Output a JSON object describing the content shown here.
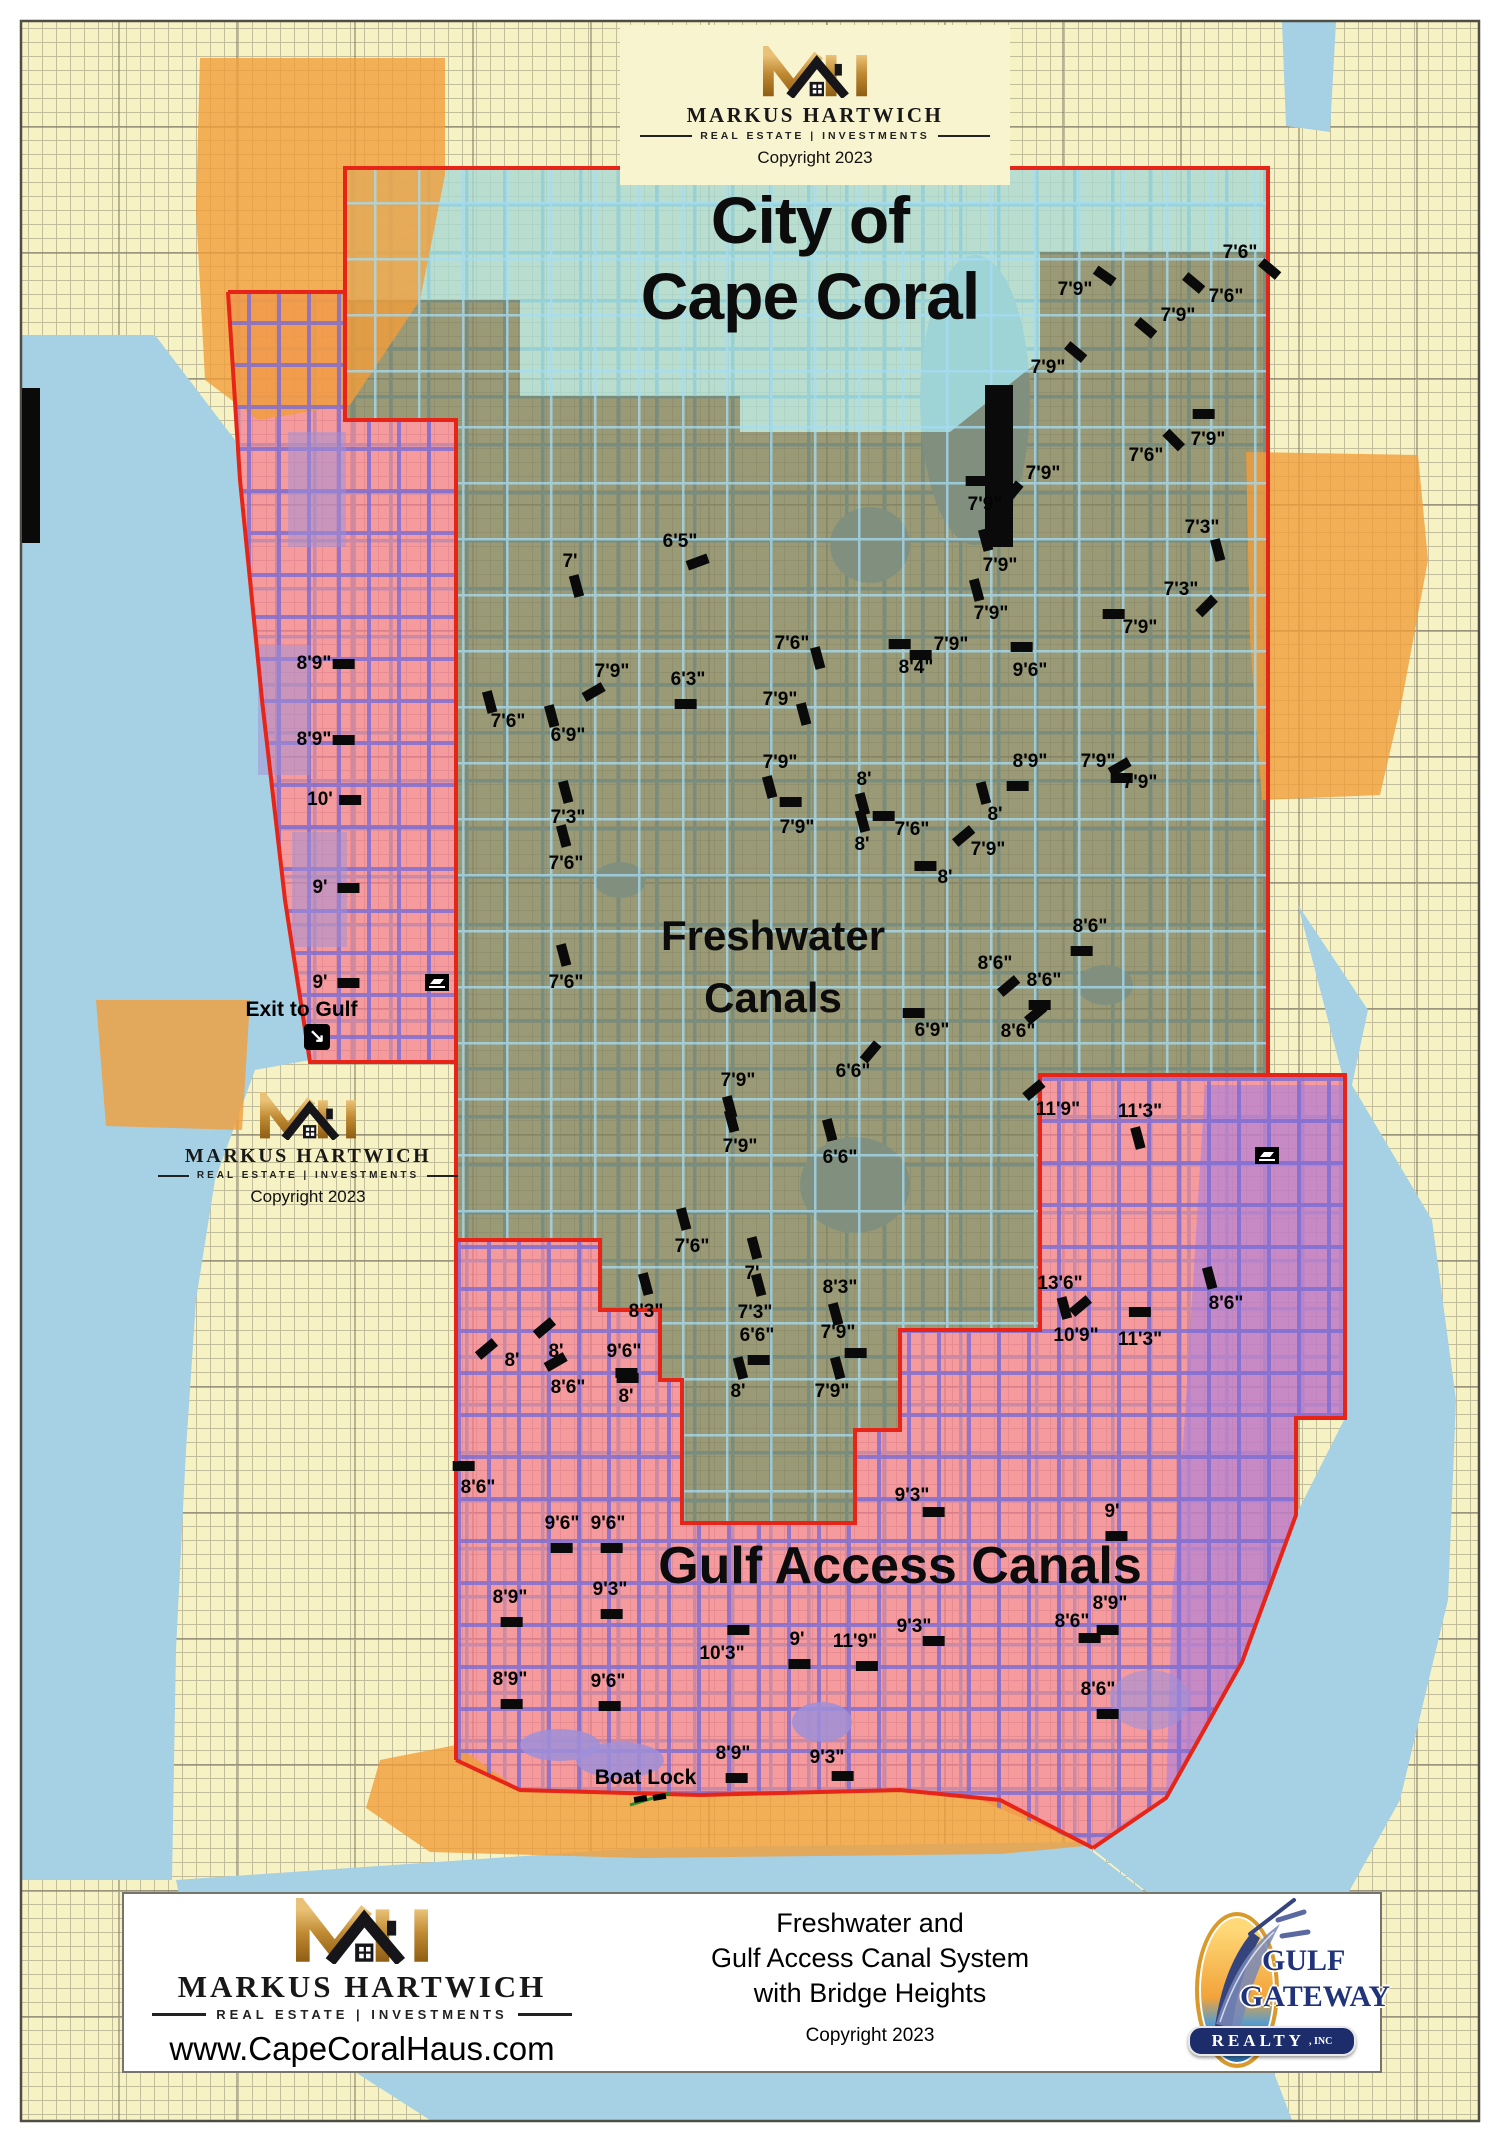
{
  "branding": {
    "monogram": "MH",
    "name": "MARKUS HARTWICH",
    "tagline": "REAL ESTATE | INVESTMENTS",
    "copyright": "Copyright 2023",
    "website": "www.CapeCoralHaus.com"
  },
  "map": {
    "title_line1": "City of",
    "title_line2": "Cape Coral",
    "freshwater_label_line1": "Freshwater",
    "freshwater_label_line2": "Canals",
    "gulf_access_label": "Gulf Access Canals",
    "exit_to_gulf_label": "Exit to Gulf",
    "boat_lock_label": "Boat Lock",
    "colors": {
      "land": "#f7f2c4",
      "water": "#a6d0e4",
      "canal_blue": "#58b6e4",
      "canal_purple": "#7b6cd4",
      "teal": "#a8d8d4",
      "olive": "#818162",
      "pink": "#f4798f",
      "violet": "#a97fe0",
      "orange": "#f19e39",
      "boundary_red": "#e62417",
      "marker_black": "#0a0a0a",
      "gold": "#c98a2e",
      "navy": "#1d2d6b"
    },
    "bridge_heights": [
      [
        "7'6\"",
        1240,
        253,
        30,
        16,
        40
      ],
      [
        "7'9\"",
        1075,
        290,
        30,
        -14,
        35
      ],
      [
        "7'6\"",
        1226,
        297,
        -32,
        -14,
        40
      ],
      [
        "7'9\"",
        1178,
        316,
        -32,
        12,
        40
      ],
      [
        "7'9\"",
        1048,
        368,
        28,
        -16,
        40
      ],
      [
        "7'9\"",
        1208,
        440,
        -4,
        -26,
        0
      ],
      [
        "7'6\"",
        1146,
        456,
        28,
        -16,
        45
      ],
      [
        "7'9\"",
        1043,
        474,
        -30,
        18,
        -50
      ],
      [
        "7'9\"",
        985,
        505,
        -8,
        -24,
        0
      ],
      [
        "7'3\"",
        1202,
        528,
        16,
        22,
        75
      ],
      [
        "7'9\"",
        1000,
        566,
        -14,
        -26,
        75
      ],
      [
        "7'3\"",
        1181,
        590,
        26,
        16,
        -45
      ],
      [
        "7'9\"",
        991,
        614,
        -14,
        -24,
        75
      ],
      [
        "7'9\"",
        1140,
        628,
        -26,
        -14,
        0
      ],
      [
        "7'9\"",
        951,
        645,
        -30,
        10,
        0
      ],
      [
        "8'4\"",
        916,
        668,
        -16,
        -24,
        0
      ],
      [
        "9'6\"",
        1030,
        671,
        -8,
        -24,
        0
      ],
      [
        "8'9\"",
        1030,
        762,
        -12,
        24,
        0
      ],
      [
        "7'9\"",
        1098,
        762,
        24,
        16,
        0
      ],
      [
        "7'9\"",
        1140,
        783,
        -20,
        -16,
        -30
      ],
      [
        "8'",
        995,
        815,
        -12,
        -22,
        75
      ],
      [
        "7'6\"",
        912,
        830,
        -28,
        -14,
        0
      ],
      [
        "7'9\"",
        988,
        850,
        -24,
        -14,
        -40
      ],
      [
        "8'",
        945,
        878,
        -20,
        -12,
        0
      ],
      [
        "6'5\"",
        680,
        542,
        18,
        20,
        -20
      ],
      [
        "7'",
        570,
        562,
        6,
        24,
        75
      ],
      [
        "7'6\"",
        792,
        644,
        26,
        14,
        75
      ],
      [
        "7'9\"",
        612,
        672,
        -18,
        20,
        -30
      ],
      [
        "6'3\"",
        688,
        680,
        -2,
        24,
        0
      ],
      [
        "7'9\"",
        780,
        700,
        24,
        14,
        75
      ],
      [
        "7'6\"",
        508,
        722,
        -18,
        -20,
        75
      ],
      [
        "6'9\"",
        568,
        736,
        -16,
        -20,
        75
      ],
      [
        "7'9\"",
        780,
        763,
        -10,
        24,
        75
      ],
      [
        "8'",
        864,
        780,
        -2,
        24,
        75
      ],
      [
        "7'3\"",
        568,
        818,
        -2,
        -26,
        75
      ],
      [
        "7'9\"",
        797,
        828,
        -6,
        -26,
        0
      ],
      [
        "8'",
        862,
        845,
        0,
        -24,
        75
      ],
      [
        "7'6\"",
        566,
        864,
        -2,
        -28,
        75
      ],
      [
        "7'6\"",
        566,
        983,
        -2,
        -28,
        75
      ],
      [
        "8'9\"",
        314,
        664,
        30,
        0,
        0
      ],
      [
        "8'9\"",
        314,
        740,
        30,
        0,
        0
      ],
      [
        "10'",
        320,
        800,
        30,
        0,
        0
      ],
      [
        "9'",
        320,
        888,
        28,
        0,
        0
      ],
      [
        "9'",
        320,
        983,
        28,
        0,
        0
      ],
      [
        "8'6\"",
        1090,
        927,
        -8,
        24,
        0
      ],
      [
        "8'6\"",
        995,
        964,
        14,
        22,
        -40
      ],
      [
        "8'6\"",
        1044,
        981,
        -4,
        24,
        0
      ],
      [
        "6'9\"",
        932,
        1031,
        -18,
        -18,
        0
      ],
      [
        "8'6\"",
        1018,
        1032,
        18,
        -18,
        -40
      ],
      [
        "6'6\"",
        853,
        1072,
        18,
        -20,
        -50
      ],
      [
        "7'9\"",
        738,
        1081,
        -8,
        26,
        75
      ],
      [
        "11'9\"",
        1058,
        1110,
        -24,
        -20,
        -40
      ],
      [
        "11'3\"",
        1140,
        1112,
        -2,
        26,
        75
      ],
      [
        "7'9\"",
        740,
        1147,
        -8,
        -26,
        75
      ],
      [
        "6'6\"",
        840,
        1158,
        -10,
        -28,
        75
      ],
      [
        "7'6\"",
        692,
        1247,
        -8,
        -28,
        75
      ],
      [
        "7'",
        752,
        1274,
        2,
        -26,
        75
      ],
      [
        "8'3\"",
        840,
        1288,
        -4,
        26,
        75
      ],
      [
        "13'6\"",
        1060,
        1284,
        20,
        22,
        -40
      ],
      [
        "8'3\"",
        646,
        1312,
        0,
        -28,
        75
      ],
      [
        "7'3\"",
        755,
        1313,
        4,
        -28,
        75
      ],
      [
        "6'6\"",
        757,
        1336,
        2,
        24,
        0
      ],
      [
        "7'9\"",
        838,
        1333,
        18,
        20,
        0
      ],
      [
        "8'",
        512,
        1361,
        -26,
        -12,
        -40
      ],
      [
        "8'",
        556,
        1352,
        -12,
        -24,
        -40
      ],
      [
        "9'6\"",
        624,
        1352,
        4,
        26,
        0
      ],
      [
        "8'6\"",
        568,
        1388,
        -12,
        -26,
        -30
      ],
      [
        "8'",
        626,
        1397,
        0,
        -24,
        0
      ],
      [
        "8'",
        738,
        1392,
        2,
        -24,
        75
      ],
      [
        "7'9\"",
        832,
        1392,
        6,
        -24,
        75
      ],
      [
        "8'6\"",
        1226,
        1304,
        -16,
        -26,
        75
      ],
      [
        "10'9\"",
        1076,
        1336,
        -12,
        -28,
        75
      ],
      [
        "11'3\"",
        1140,
        1340,
        0,
        -28,
        0
      ],
      [
        "8'6\"",
        478,
        1488,
        -14,
        -22,
        0
      ],
      [
        "9'6\"",
        562,
        1524,
        0,
        24,
        0
      ],
      [
        "9'6\"",
        608,
        1524,
        4,
        24,
        0
      ],
      [
        "9'3\"",
        912,
        1496,
        22,
        16,
        0
      ],
      [
        "9'",
        1112,
        1512,
        4,
        24,
        0
      ],
      [
        "8'9\"",
        510,
        1598,
        2,
        24,
        0
      ],
      [
        "9'3\"",
        610,
        1590,
        2,
        24,
        0
      ],
      [
        "10'3\"",
        722,
        1654,
        16,
        -24,
        0
      ],
      [
        "9'",
        797,
        1640,
        2,
        24,
        0
      ],
      [
        "11'9\"",
        855,
        1642,
        12,
        24,
        0
      ],
      [
        "9'3\"",
        914,
        1627,
        20,
        14,
        0
      ],
      [
        "8'9\"",
        510,
        1680,
        2,
        24,
        0
      ],
      [
        "9'6\"",
        608,
        1682,
        2,
        24,
        0
      ],
      [
        "8'9\"",
        733,
        1754,
        4,
        24,
        0
      ],
      [
        "9'3\"",
        827,
        1758,
        16,
        18,
        0
      ],
      [
        "8'9\"",
        1110,
        1604,
        -2,
        26,
        0
      ],
      [
        "8'6\"",
        1072,
        1622,
        18,
        16,
        0
      ],
      [
        "8'6\"",
        1098,
        1690,
        10,
        24,
        0
      ]
    ],
    "boat_ramps": [
      [
        437,
        982
      ],
      [
        1267,
        1155
      ]
    ],
    "structures": [
      [
        22,
        388,
        18,
        155
      ],
      [
        985,
        385,
        28,
        162
      ]
    ]
  },
  "footer": {
    "title_line1": "Freshwater and",
    "title_line2": "Gulf Access Canal System",
    "title_line3": "with Bridge Heights",
    "copyright": "Copyright 2023",
    "realty": {
      "word1": "GULF",
      "word2": "GATEWAY",
      "word3": "REALTY",
      "word4": ", INC"
    }
  }
}
